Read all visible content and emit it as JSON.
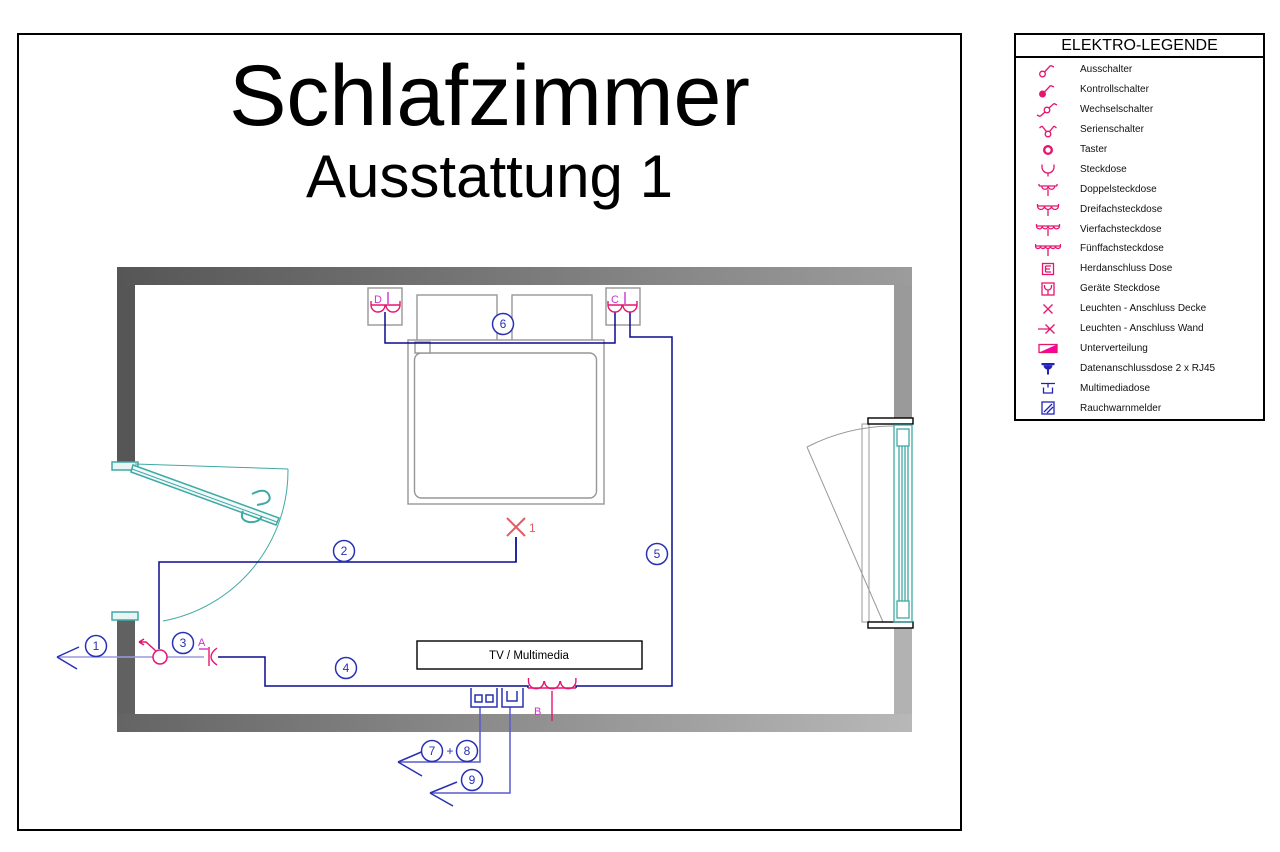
{
  "title": {
    "main": "Schlafzimmer",
    "sub": "Ausstattung 1"
  },
  "legend": {
    "title": "ELEKTRO-LEGENDE",
    "items": [
      {
        "symbol": "ausschalter-icon",
        "label": "Ausschalter"
      },
      {
        "symbol": "kontrollschalter-icon",
        "label": "Kontrollschalter"
      },
      {
        "symbol": "wechselschalter-icon",
        "label": "Wechselschalter"
      },
      {
        "symbol": "serienschalter-icon",
        "label": "Serienschalter"
      },
      {
        "symbol": "taster-icon",
        "label": "Taster"
      },
      {
        "symbol": "steckdose-icon",
        "label": "Steckdose"
      },
      {
        "symbol": "doppelsteckdose-icon",
        "label": "Doppelsteckdose"
      },
      {
        "symbol": "dreifachsteckdose-icon",
        "label": "Dreifachsteckdose"
      },
      {
        "symbol": "vierfachsteckdose-icon",
        "label": "Vierfachsteckdose"
      },
      {
        "symbol": "fuenffachsteckdose-icon",
        "label": "Fünffachsteckdose"
      },
      {
        "symbol": "herdanschluss-dose-icon",
        "label": "Herdanschluss Dose"
      },
      {
        "symbol": "geraete-steckdose-icon",
        "label": "Geräte Steckdose"
      },
      {
        "symbol": "leuchten-anschluss-decke-icon",
        "label": "Leuchten - Anschluss Decke"
      },
      {
        "symbol": "leuchten-anschluss-wand-icon",
        "label": "Leuchten - Anschluss Wand"
      },
      {
        "symbol": "unterverteilung-icon",
        "label": "Unterverteilung"
      },
      {
        "symbol": "datenanschlussdose-icon",
        "label": "Datenanschlussdose 2 x RJ45"
      },
      {
        "symbol": "multimediadose-icon",
        "label": "Multimediadose"
      },
      {
        "symbol": "rauchwarnmelder-icon",
        "label": "Rauchwarnmelder"
      }
    ]
  },
  "plan": {
    "tv_label": "TV / Multimedia",
    "outlet_labels": {
      "a": "A",
      "b": "B",
      "c": "C",
      "d": "D"
    },
    "ceiling_light_label": "1",
    "circuit_numbers": {
      "c1": "1",
      "c2": "2",
      "c3": "3",
      "c4": "4",
      "c5": "5",
      "c6": "6",
      "c7": "7",
      "c8": "8",
      "c9": "9"
    },
    "plus_sign": "+"
  },
  "colors": {
    "symbol_magenta": "#e6156e",
    "label_magenta": "#cc33cc",
    "wire_navy": "#0a0a90",
    "circle_blue": "#2830b4",
    "data_blue": "#5a5ace",
    "switched_wire_lavender": "#9a9ade",
    "light_red": "#e65862",
    "door_window_teal": "#3fa9a5",
    "wall_dark": "#5a5a5a",
    "wall_light": "#b4b4b4",
    "legend_blue": "#2222b8"
  }
}
